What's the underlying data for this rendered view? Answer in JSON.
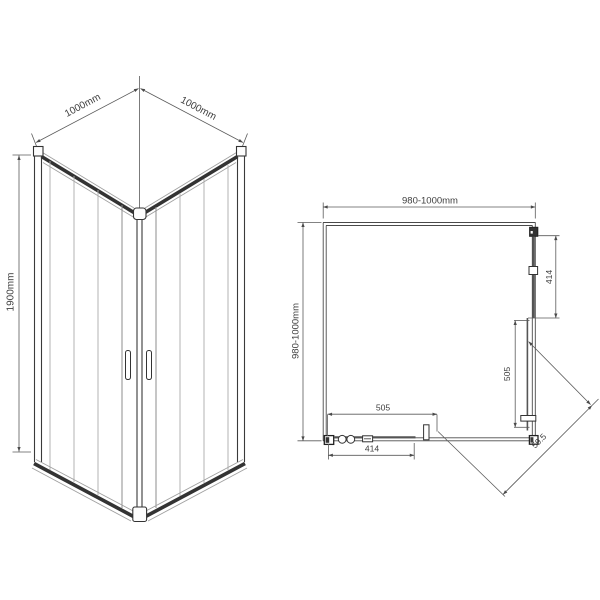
{
  "perspective_view": {
    "dim_width_left": "1000mm",
    "dim_width_right": "1000mm",
    "dim_height": "1900mm"
  },
  "plan_view": {
    "dim_top_width": "980-1000mm",
    "dim_left_depth": "980-1000mm",
    "dim_right_fixed_panel": "414",
    "dim_right_door": "505",
    "dim_bottom_opening": "505",
    "dim_bottom_door": "414",
    "dim_diagonal_entrance": "59.5"
  },
  "colors": {
    "line": "#3e3e3e",
    "background": "#ffffff"
  }
}
